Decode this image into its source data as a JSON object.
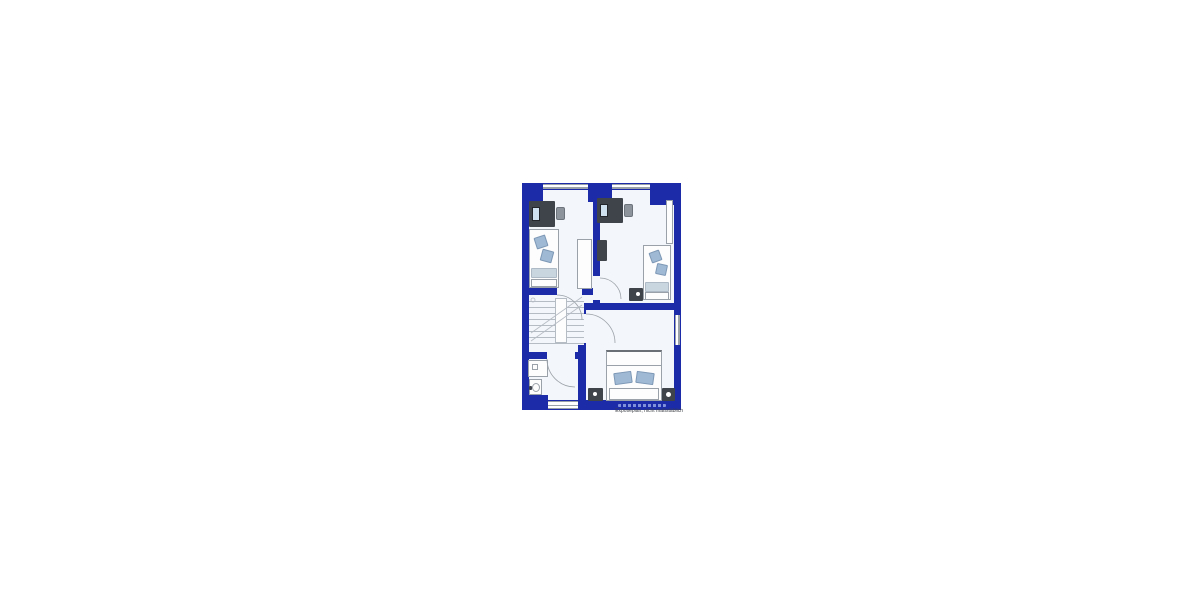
{
  "page": {
    "background": "#ffffff"
  },
  "floorplan": {
    "caption": "Exposéplan, nicht maßstäblich",
    "position": {
      "left": 522,
      "top": 183,
      "width": 159,
      "height": 227
    },
    "colors": {
      "wall": "#1c2ba8",
      "floor": "#f3f6fa",
      "furniture": "#3f434a",
      "cushion": "#9fb9d4",
      "pillow": "#c9d5df",
      "outline": "#9aa1a8",
      "stair_lines": "#b6bcc4",
      "watermark": "#8b9ce0",
      "caption": "#3e4247"
    },
    "legend_icons": [
      "desk-icon",
      "monitor-icon",
      "office-chair-icon",
      "single-bed-icon",
      "wardrobe-icon",
      "dresser-icon",
      "stairs-icon",
      "shower-icon",
      "washbasin-icon",
      "double-bed-icon",
      "nightstand-icon",
      "door-swing-icon",
      "window-icon"
    ]
  }
}
